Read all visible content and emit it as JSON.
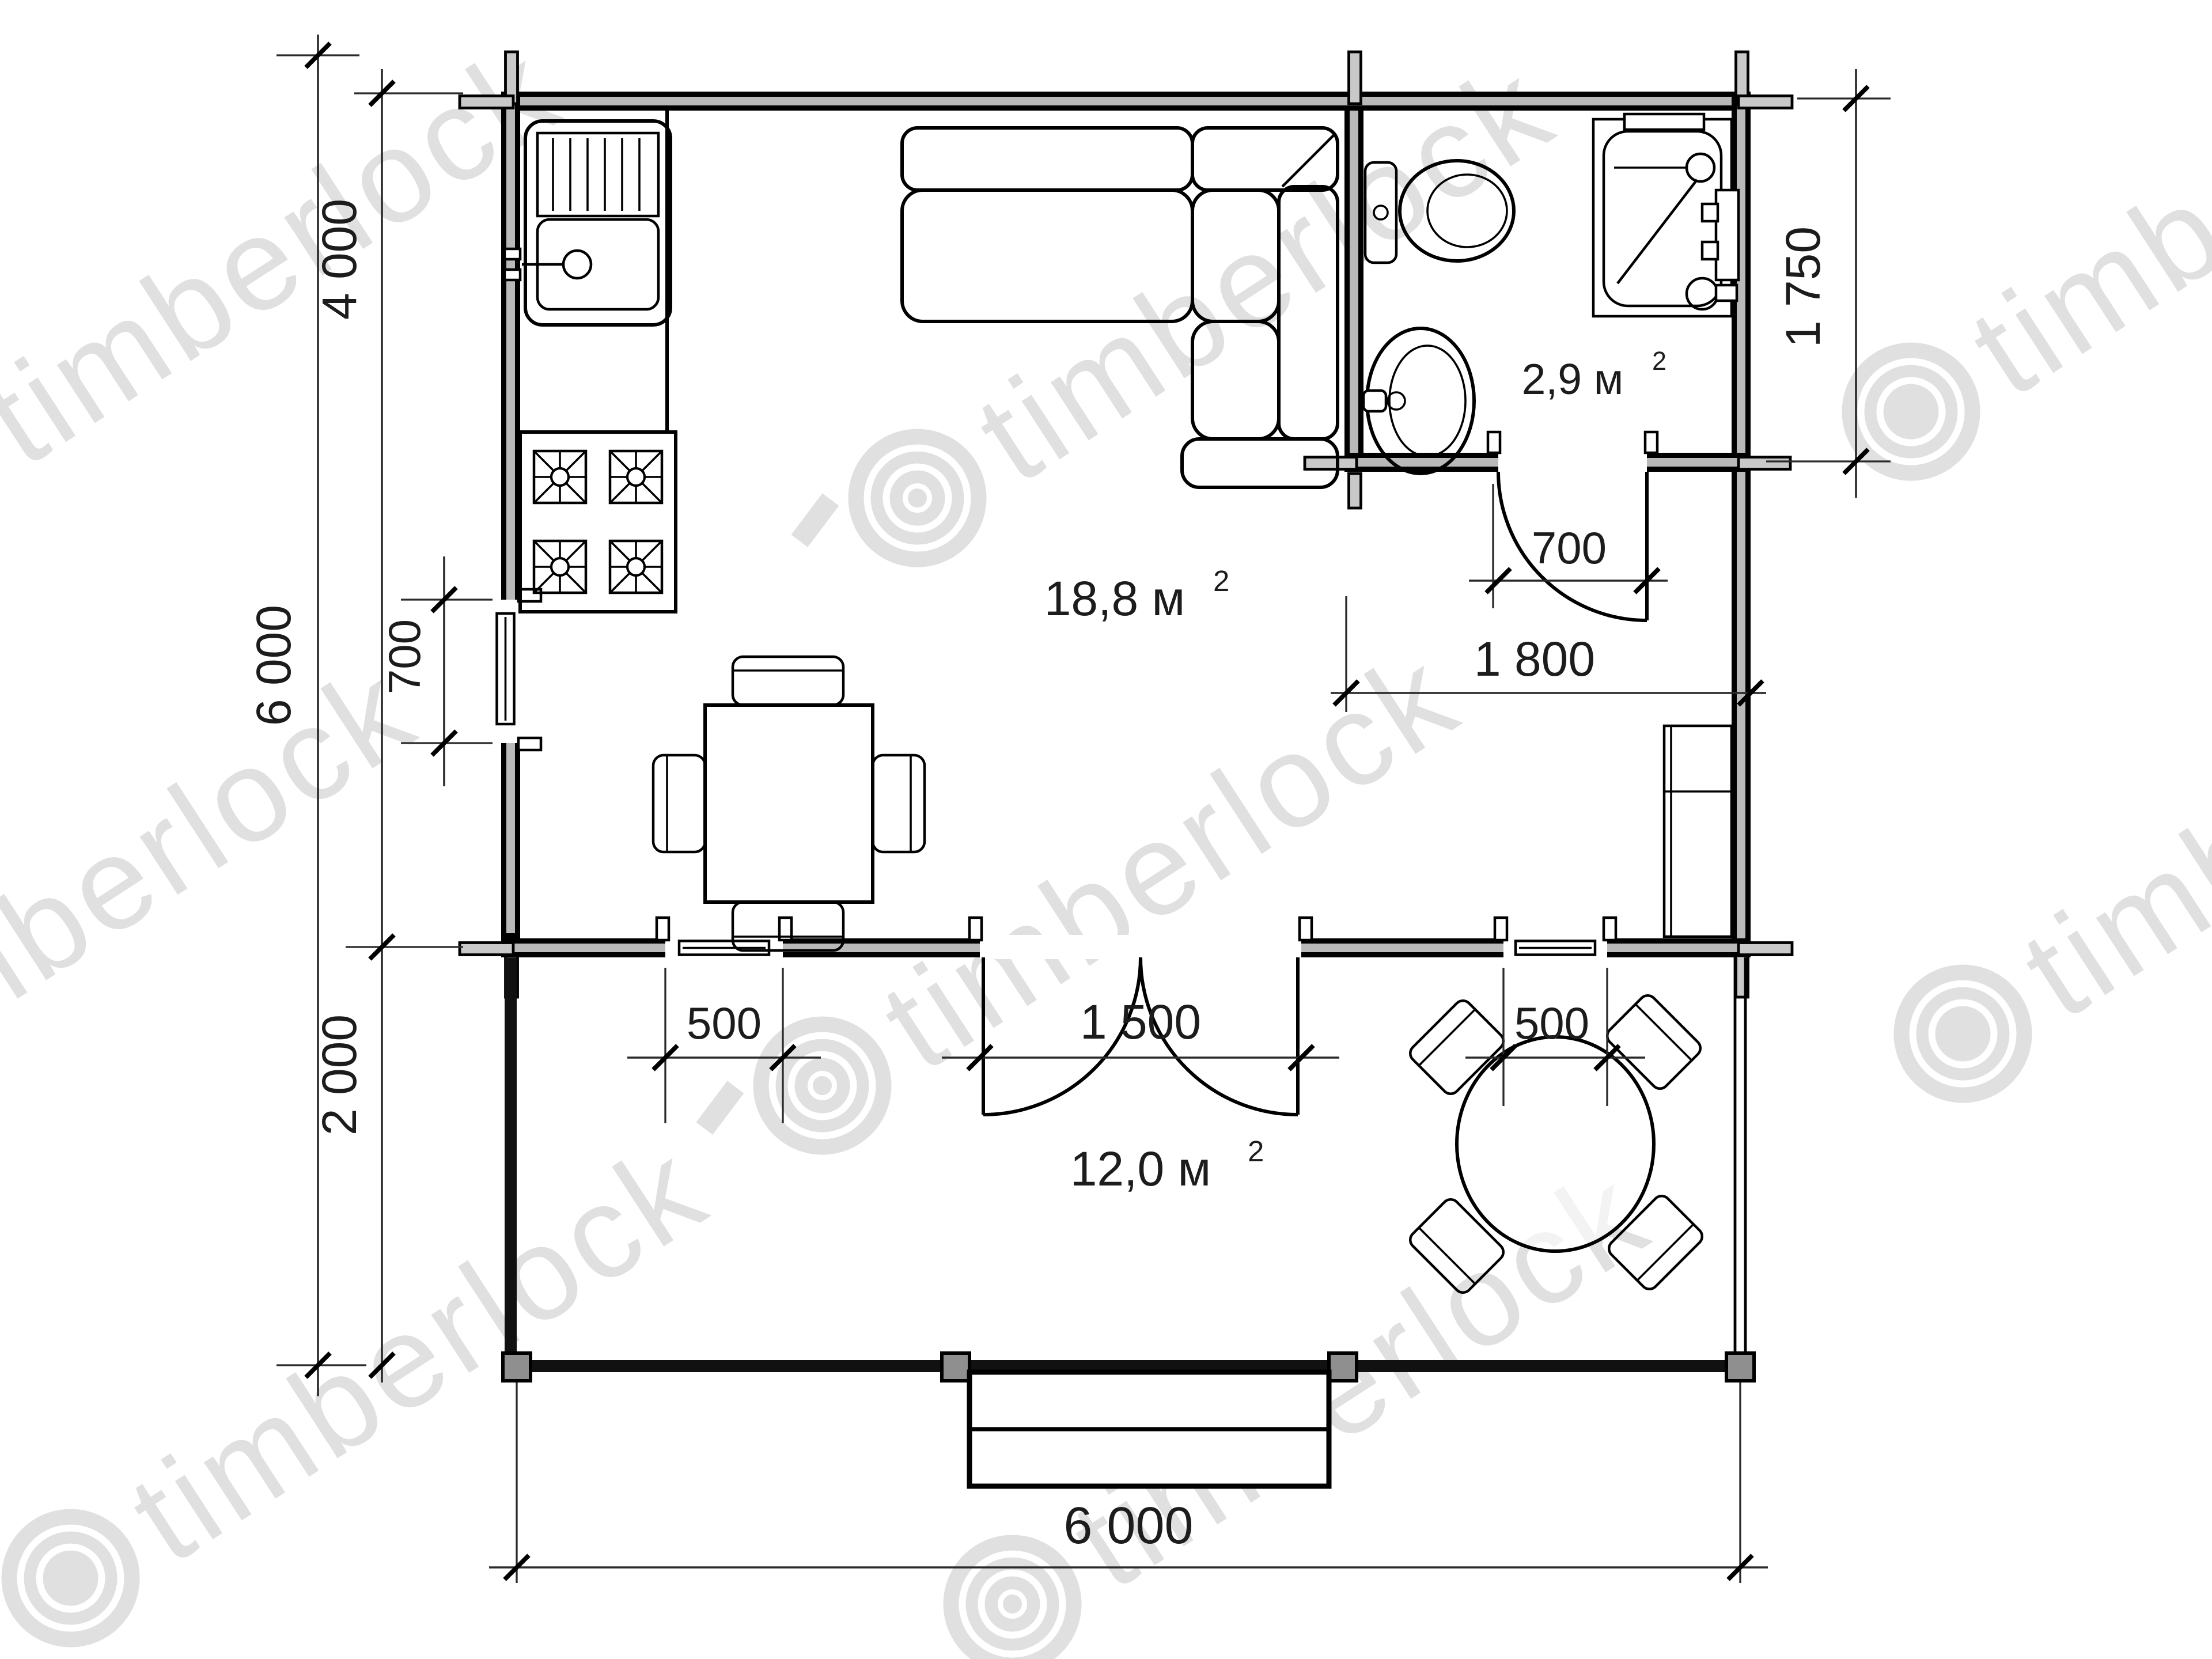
{
  "title": "Timberlock cabin floor plan 6x6",
  "watermark": {
    "text": "timberlock"
  },
  "rooms": {
    "living": {
      "area": "18,8 м",
      "sup": "2"
    },
    "bathroom": {
      "area": "2,9 м",
      "sup": "2"
    },
    "terrace": {
      "area": "12,0 м",
      "sup": "2"
    }
  },
  "dimensions": {
    "total_height": "6 000",
    "main_depth": "4 000",
    "terrace_depth": "2 000",
    "left_window": "700",
    "bathroom_depth": "1 750",
    "bathroom_door": "700",
    "bathroom_width": "1 800",
    "terrace_window_left": "500",
    "terrace_door": "1 500",
    "terrace_window_right": "500",
    "total_width": "6 000"
  },
  "colors": {
    "walls": "#000000",
    "log_core": "#b9b9b9",
    "watermark": "#e0e0e0",
    "background": "#ffffff"
  },
  "icons": {
    "kitchen_sink": "sink with drainboard",
    "stove": "4-burner stove",
    "sofa": "L-shaped corner sofa",
    "dining_table": "square table with 4 chairs",
    "toilet": "toilet",
    "washbasin": "washbasin",
    "shower": "shower tray",
    "wardrobe": "wardrobe",
    "terrace_table": "round table with 4 chairs",
    "steps": "entrance steps"
  }
}
